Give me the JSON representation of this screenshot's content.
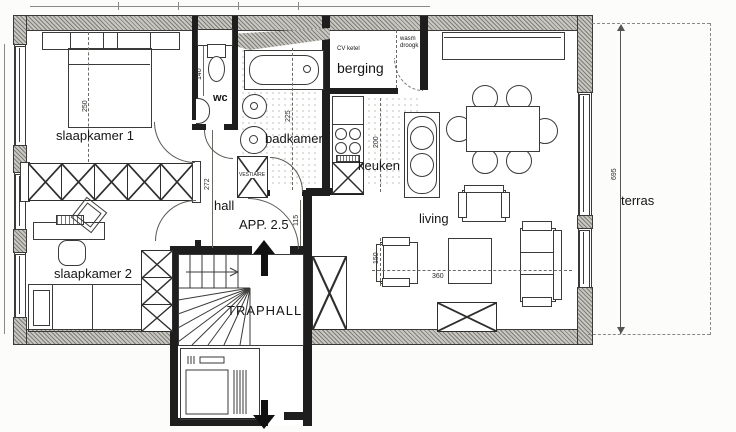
{
  "plan": {
    "apartment_label": "APP. 2.5",
    "rooms": {
      "slaapkamer1": "slaapkamer 1",
      "slaapkamer2": "slaapkamer 2",
      "wc": "wc",
      "badkamer": "badkamer",
      "vestiaire": "VESTIAIRE",
      "berging": "berging",
      "keuken": "keuken",
      "hall": "hall",
      "traphall": "TRAPHALL",
      "living": "living",
      "terras": "terras"
    },
    "equipment": {
      "cv_ketel": "CV ketel",
      "wasm_droogk": "wasm droogk"
    },
    "dimensions": {
      "bed_width": "250",
      "hall_height": "272",
      "badkamer_depth": "225",
      "keuken_depth": "200",
      "wc_depth": "140",
      "entrance_door": "115",
      "living_width": "360",
      "seat_width": "150",
      "terras_length": "695"
    },
    "colors": {
      "ink": "#1e1e1e",
      "wall_hatch": "#c9c7c1",
      "paper": "#fcfcfa"
    }
  }
}
